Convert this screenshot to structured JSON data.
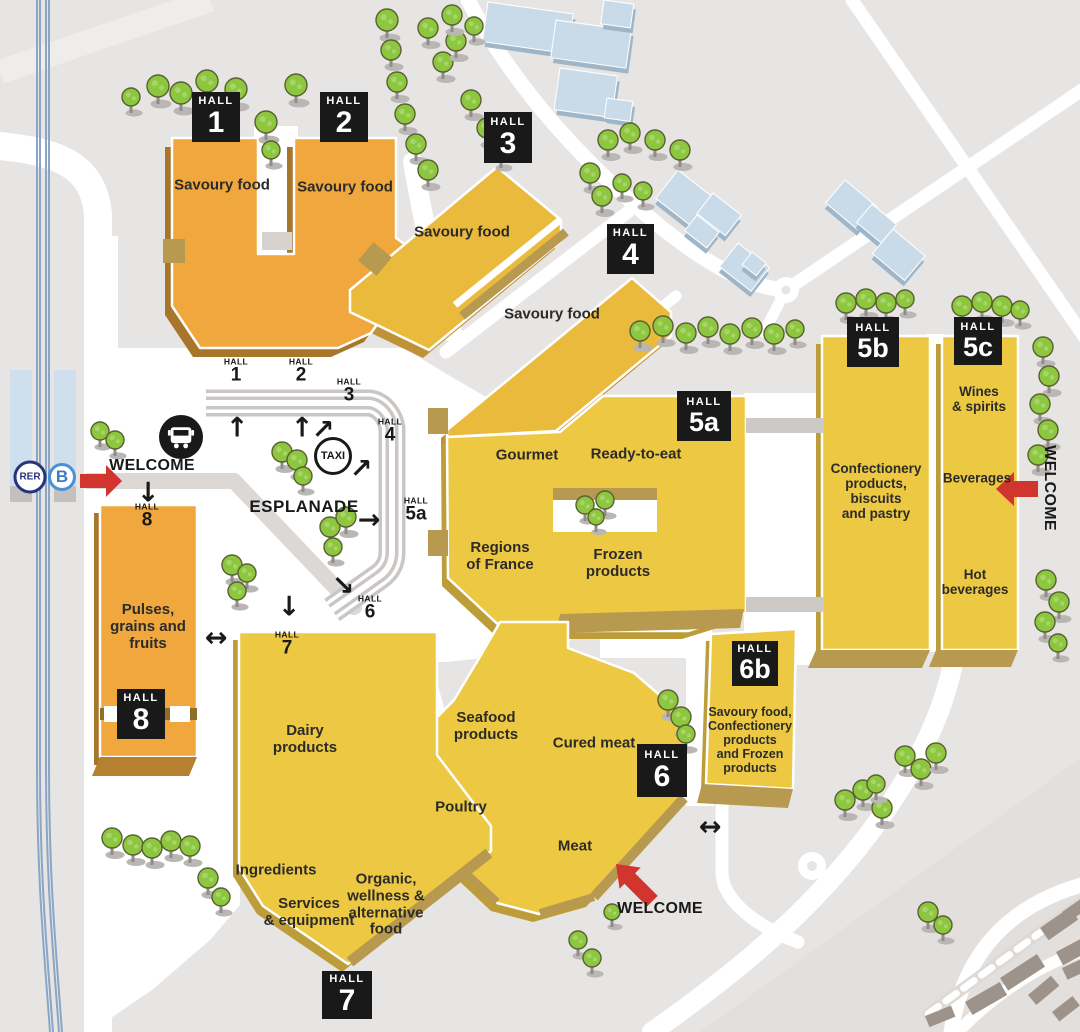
{
  "halls": {
    "h1": {
      "badge_top": "HALL",
      "badge_num": "1",
      "category": "Savoury food"
    },
    "h2": {
      "badge_top": "HALL",
      "badge_num": "2",
      "category": "Savoury food"
    },
    "h3": {
      "badge_top": "HALL",
      "badge_num": "3",
      "category": "Savoury food"
    },
    "h4": {
      "badge_top": "HALL",
      "badge_num": "4",
      "category": "Savoury food"
    },
    "h5a": {
      "badge_top": "HALL",
      "badge_num": "5a",
      "cat_gourmet": "Gourmet",
      "cat_ready_to_eat": "Ready-to-eat",
      "cat_regions": "Regions\nof France",
      "cat_frozen": "Frozen\nproducts"
    },
    "h5b": {
      "badge_top": "HALL",
      "badge_num": "5b",
      "category": "Confectionery\nproducts,\nbiscuits\nand pastry"
    },
    "h5c": {
      "badge_top": "HALL",
      "badge_num": "5c",
      "cat_wines": "Wines\n& spirits",
      "cat_beverages": "Beverages",
      "cat_hot_beverages": "Hot\nbeverages"
    },
    "h6": {
      "badge_top": "HALL",
      "badge_num": "6",
      "cat_seafood": "Seafood\nproducts",
      "cat_cured_meat": "Cured meat",
      "cat_poultry": "Poultry",
      "cat_meat": "Meat"
    },
    "h6b": {
      "badge_top": "HALL",
      "badge_num": "6b",
      "category": "Savoury food,\nConfectionery\nproducts\nand Frozen\nproducts"
    },
    "h7": {
      "badge_top": "HALL",
      "badge_num": "7",
      "cat_dairy": "Dairy\nproducts",
      "cat_ingredients": "Ingredients",
      "cat_services": "Services\n& equipment",
      "cat_organic": "Organic,\nwellness &\nalternative\nfood"
    },
    "h8": {
      "badge_top": "HALL",
      "badge_num": "8",
      "category": "Pulses,\ngrains and\nfruits"
    }
  },
  "esplanade": {
    "label": "ESPLANADE"
  },
  "transport": {
    "rer": "RER",
    "line_letter": "B",
    "taxi": "TAXI"
  },
  "welcome": {
    "left": "WELCOME",
    "right": "WELCOME",
    "bottom": "WELCOME"
  },
  "minis": {
    "m1": {
      "top": "HALL",
      "num": "1"
    },
    "m2": {
      "top": "HALL",
      "num": "2"
    },
    "m3": {
      "top": "HALL",
      "num": "3"
    },
    "m4": {
      "top": "HALL",
      "num": "4"
    },
    "m5a": {
      "top": "HALL",
      "num": "5a"
    },
    "m6": {
      "top": "HALL",
      "num": "6"
    },
    "m7": {
      "top": "HALL",
      "num": "7"
    },
    "m8": {
      "top": "HALL",
      "num": "8"
    }
  },
  "icons": {
    "arrow_up": "↑",
    "arrow_down": "↓",
    "arrow_right": "→",
    "arrow_up_right": "↗",
    "arrow_down_right": "↘",
    "arrow_left_right": "↔"
  },
  "colors": {
    "hall_orange": "#efa73e",
    "hall_orange_side": "#a8762a",
    "hall_yellow": "#ecc843",
    "hall_yellow_deep": "#eaba3d",
    "hall_yellow_side": "#bd9c3a",
    "tan_edge": "#b79a4f",
    "accent_red": "#d2342e",
    "badge_black": "#191919",
    "tree_green": "#8dc63f",
    "building_blue": "#c9dbe9",
    "building_gray": "#9d938b",
    "ground": "#e7e5e4",
    "road_white": "#ffffff",
    "rail_blue": "#8aa5c6"
  },
  "scene": {
    "trees": [
      [
        158,
        86,
        11
      ],
      [
        181,
        93,
        11
      ],
      [
        207,
        81,
        11
      ],
      [
        236,
        89,
        11
      ],
      [
        131,
        97,
        9
      ],
      [
        266,
        122,
        11
      ],
      [
        271,
        150,
        9
      ],
      [
        296,
        85,
        11
      ],
      [
        387,
        20,
        11
      ],
      [
        391,
        50,
        10
      ],
      [
        397,
        82,
        10
      ],
      [
        405,
        114,
        10
      ],
      [
        416,
        144,
        10
      ],
      [
        428,
        170,
        10
      ],
      [
        443,
        62,
        10
      ],
      [
        456,
        41,
        10
      ],
      [
        428,
        28,
        10
      ],
      [
        452,
        15,
        10
      ],
      [
        474,
        26,
        9
      ],
      [
        471,
        100,
        10
      ],
      [
        487,
        128,
        10
      ],
      [
        501,
        152,
        9
      ],
      [
        590,
        173,
        10
      ],
      [
        602,
        196,
        10
      ],
      [
        608,
        140,
        10
      ],
      [
        630,
        133,
        10
      ],
      [
        655,
        140,
        10
      ],
      [
        680,
        150,
        10
      ],
      [
        622,
        183,
        9
      ],
      [
        643,
        191,
        9
      ],
      [
        640,
        331,
        10
      ],
      [
        663,
        326,
        10
      ],
      [
        686,
        333,
        10
      ],
      [
        708,
        327,
        10
      ],
      [
        730,
        334,
        10
      ],
      [
        752,
        328,
        10
      ],
      [
        774,
        334,
        10
      ],
      [
        795,
        329,
        9
      ],
      [
        846,
        303,
        10
      ],
      [
        866,
        299,
        10
      ],
      [
        886,
        303,
        10
      ],
      [
        905,
        299,
        9
      ],
      [
        962,
        306,
        10
      ],
      [
        982,
        302,
        10
      ],
      [
        1002,
        306,
        10
      ],
      [
        1020,
        310,
        9
      ],
      [
        1043,
        347,
        10
      ],
      [
        1049,
        376,
        10
      ],
      [
        1040,
        404,
        10
      ],
      [
        1048,
        430,
        10
      ],
      [
        1038,
        455,
        10
      ],
      [
        1046,
        580,
        10
      ],
      [
        1059,
        602,
        10
      ],
      [
        1045,
        622,
        10
      ],
      [
        1058,
        643,
        9
      ],
      [
        585,
        505,
        9
      ],
      [
        605,
        500,
        9
      ],
      [
        596,
        517,
        8
      ],
      [
        282,
        452,
        10
      ],
      [
        297,
        460,
        10
      ],
      [
        303,
        476,
        9
      ],
      [
        330,
        527,
        10
      ],
      [
        346,
        517,
        10
      ],
      [
        333,
        547,
        9
      ],
      [
        232,
        565,
        10
      ],
      [
        247,
        573,
        9
      ],
      [
        237,
        591,
        9
      ],
      [
        100,
        431,
        9
      ],
      [
        115,
        440,
        9
      ],
      [
        112,
        838,
        10
      ],
      [
        133,
        845,
        10
      ],
      [
        152,
        848,
        10
      ],
      [
        171,
        841,
        10
      ],
      [
        190,
        846,
        10
      ],
      [
        208,
        878,
        10
      ],
      [
        221,
        897,
        9
      ],
      [
        668,
        700,
        10
      ],
      [
        681,
        717,
        10
      ],
      [
        686,
        734,
        9
      ],
      [
        612,
        912,
        8
      ],
      [
        578,
        940,
        9
      ],
      [
        592,
        958,
        9
      ],
      [
        845,
        800,
        10
      ],
      [
        863,
        790,
        10
      ],
      [
        882,
        808,
        10
      ],
      [
        905,
        756,
        10
      ],
      [
        921,
        769,
        10
      ],
      [
        936,
        753,
        10
      ],
      [
        876,
        784,
        9
      ],
      [
        928,
        912,
        10
      ],
      [
        943,
        925,
        9
      ]
    ],
    "blue_buildings": [
      [
        488,
        2,
        86,
        40,
        8
      ],
      [
        556,
        20,
        76,
        38,
        8
      ],
      [
        604,
        0,
        30,
        24,
        8
      ],
      [
        560,
        68,
        58,
        42,
        8
      ],
      [
        607,
        98,
        26,
        20,
        8
      ],
      [
        678,
        170,
        52,
        36,
        38
      ],
      [
        713,
        193,
        36,
        26,
        38
      ],
      [
        697,
        215,
        28,
        20,
        38
      ],
      [
        738,
        243,
        40,
        30,
        38
      ],
      [
        752,
        252,
        18,
        16,
        38
      ],
      [
        845,
        180,
        42,
        30,
        40
      ],
      [
        872,
        204,
        32,
        24,
        40
      ],
      [
        893,
        229,
        42,
        32,
        40
      ]
    ],
    "gray_buildings": [
      [
        1040,
        928,
        36,
        15,
        -35
      ],
      [
        1056,
        952,
        40,
        15,
        -28
      ],
      [
        1062,
        912,
        24,
        12,
        -35
      ],
      [
        1000,
        978,
        44,
        15,
        -33
      ],
      [
        1028,
        995,
        30,
        13,
        -40
      ],
      [
        1062,
        968,
        30,
        13,
        -25
      ],
      [
        965,
        1002,
        40,
        15,
        -30
      ],
      [
        925,
        1016,
        28,
        12,
        -22
      ],
      [
        1052,
        1012,
        26,
        12,
        -38
      ]
    ]
  }
}
